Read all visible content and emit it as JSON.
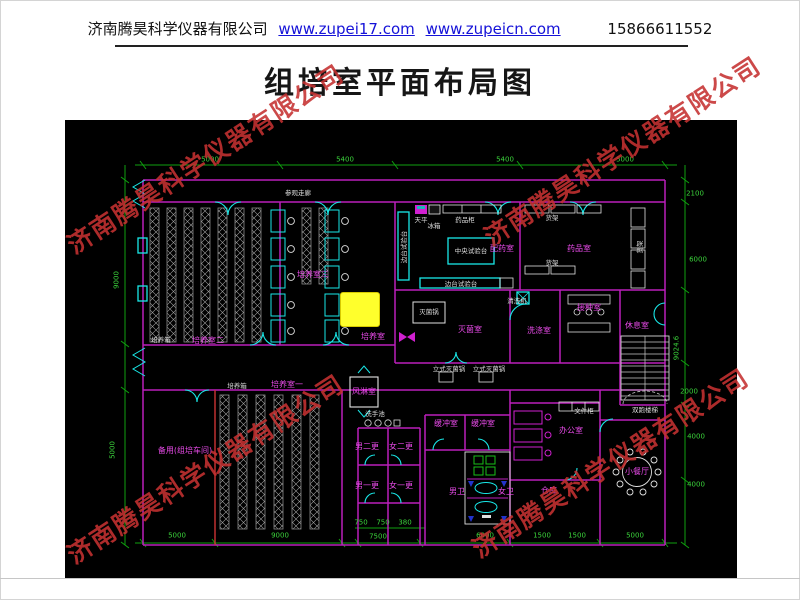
{
  "header": {
    "company": "济南腾昊科学仪器有限公司",
    "link1": "www.zupei17.com",
    "link2": "www.zupeicn.com",
    "phone": "15866611552"
  },
  "title": "组培室平面布局图",
  "watermark": {
    "text": "济南腾昊科学仪器有限公司",
    "color": "#c53131",
    "positions": [
      {
        "x": 205,
        "y": 158
      },
      {
        "x": 622,
        "y": 150
      },
      {
        "x": 205,
        "y": 468
      },
      {
        "x": 610,
        "y": 462
      }
    ]
  },
  "plan": {
    "colors": {
      "background": "#000000",
      "wall": "#bb1fbb",
      "door": "#19e8e8",
      "dimension": "#0fa00f",
      "room_label": "#e84ae8",
      "equipment_label": "#dedede",
      "highlight": "#ffff2c",
      "watermark": "#c53131"
    },
    "highlight": {
      "x": 275,
      "y": 172,
      "w": 38,
      "h": 33
    },
    "room_labels": [
      {
        "t": "培养室二",
        "x": 143,
        "y": 221
      },
      {
        "t": "培养室三",
        "x": 248,
        "y": 155
      },
      {
        "t": "培养室",
        "x": 308,
        "y": 217
      },
      {
        "t": "配药室",
        "x": 437,
        "y": 129
      },
      {
        "t": "药品室",
        "x": 514,
        "y": 129
      },
      {
        "t": "灭菌室",
        "x": 405,
        "y": 210
      },
      {
        "t": "洗涤室",
        "x": 474,
        "y": 211
      },
      {
        "t": "接种室",
        "x": 524,
        "y": 188
      },
      {
        "t": "休息室",
        "x": 572,
        "y": 206
      },
      {
        "t": "培养室一",
        "x": 222,
        "y": 265
      },
      {
        "t": "备用(组培车间)",
        "x": 120,
        "y": 331
      },
      {
        "t": "风淋室",
        "x": 299,
        "y": 272
      },
      {
        "t": "缓冲室",
        "x": 381,
        "y": 304
      },
      {
        "t": "缓冲室",
        "x": 418,
        "y": 304
      },
      {
        "t": "男二更",
        "x": 302,
        "y": 327
      },
      {
        "t": "女二更",
        "x": 336,
        "y": 327
      },
      {
        "t": "男一更",
        "x": 302,
        "y": 366
      },
      {
        "t": "女一更",
        "x": 336,
        "y": 366
      },
      {
        "t": "男卫",
        "x": 392,
        "y": 372
      },
      {
        "t": "女卫",
        "x": 441,
        "y": 372
      },
      {
        "t": "办公室",
        "x": 506,
        "y": 311
      },
      {
        "t": "仓库",
        "x": 484,
        "y": 371
      },
      {
        "t": "小餐厅",
        "x": 572,
        "y": 352
      }
    ],
    "equipment_labels": [
      {
        "t": "参观走廊",
        "x": 233,
        "y": 73
      },
      {
        "t": "培养箱",
        "x": 96,
        "y": 220
      },
      {
        "t": "培养箱",
        "x": 172,
        "y": 266
      },
      {
        "t": "中央试验台",
        "x": 406,
        "y": 131
      },
      {
        "t": "边台试验台",
        "x": 339,
        "y": 127,
        "r": 1
      },
      {
        "t": "边台试验台",
        "x": 396,
        "y": 164
      },
      {
        "t": "天平",
        "x": 356,
        "y": 100
      },
      {
        "t": "冰箱",
        "x": 369,
        "y": 106
      },
      {
        "t": "药品柜",
        "x": 400,
        "y": 100
      },
      {
        "t": "货架",
        "x": 487,
        "y": 98
      },
      {
        "t": "货架",
        "x": 487,
        "y": 143
      },
      {
        "t": "货架",
        "x": 575,
        "y": 127,
        "r": 1
      },
      {
        "t": "灭菌锅",
        "x": 364,
        "y": 192
      },
      {
        "t": "清洗机",
        "x": 452,
        "y": 181
      },
      {
        "t": "立式灭菌锅",
        "x": 384,
        "y": 249
      },
      {
        "t": "立式灭菌锅",
        "x": 424,
        "y": 249
      },
      {
        "t": "洗手池",
        "x": 310,
        "y": 294
      },
      {
        "t": "文件柜",
        "x": 519,
        "y": 291
      },
      {
        "t": "双跑楼梯",
        "x": 580,
        "y": 290
      }
    ],
    "dimensions": [
      {
        "t": "5000",
        "x": 145,
        "y": 40
      },
      {
        "t": "5400",
        "x": 280,
        "y": 40
      },
      {
        "t": "5400",
        "x": 440,
        "y": 40
      },
      {
        "t": "5000",
        "x": 560,
        "y": 40
      },
      {
        "t": "9000",
        "x": 52,
        "y": 160,
        "r": 1
      },
      {
        "t": "5000",
        "x": 48,
        "y": 330,
        "r": 1
      },
      {
        "t": "2100",
        "x": 630,
        "y": 74
      },
      {
        "t": "6000",
        "x": 633,
        "y": 140
      },
      {
        "t": "9024.6",
        "x": 612,
        "y": 228,
        "r": 1
      },
      {
        "t": "2000",
        "x": 624,
        "y": 272
      },
      {
        "t": "4000",
        "x": 631,
        "y": 317
      },
      {
        "t": "4000",
        "x": 631,
        "y": 365
      },
      {
        "t": "5000",
        "x": 112,
        "y": 416
      },
      {
        "t": "9000",
        "x": 215,
        "y": 416
      },
      {
        "t": "750",
        "x": 296,
        "y": 403
      },
      {
        "t": "750",
        "x": 318,
        "y": 403
      },
      {
        "t": "380",
        "x": 340,
        "y": 403
      },
      {
        "t": "7500",
        "x": 313,
        "y": 417
      },
      {
        "t": "6000",
        "x": 420,
        "y": 416
      },
      {
        "t": "1500",
        "x": 477,
        "y": 416
      },
      {
        "t": "1500",
        "x": 512,
        "y": 416
      },
      {
        "t": "5000",
        "x": 570,
        "y": 416
      }
    ]
  }
}
